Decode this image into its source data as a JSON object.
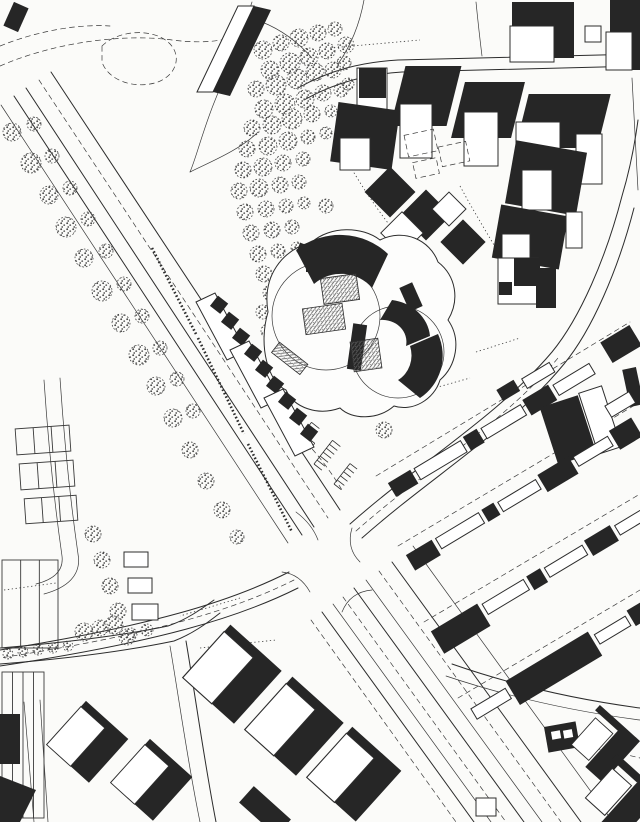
{
  "meta": {
    "kind": "scanned-site-plan-map",
    "width_px": 640,
    "height_px": 822,
    "visible_text": "none"
  },
  "palette": {
    "paper": "#fbfbf9",
    "ink": "#2c2c2c",
    "building_dark": "#262626",
    "tree_outline": "#414141",
    "hatch_gray": "#5c5c5c"
  },
  "features": {
    "park_woodland": "dense stippled tree cluster, upper centre-left",
    "main_avenue": "tree-lined avenue from top-left through central crossroads",
    "boulevard": "multi-lane boulevard from crossroads to bottom-right",
    "central_complex": "cloverleaf building complex with dark curved roofs and hatched courtyards",
    "ne_housing_cluster": "detached houses with dark roofs, top-right",
    "slab_housing": "diagonal rows of slab apartment blocks, right",
    "sports_courts": "court grid and field strips, left edge",
    "sw_villas": "houses with large cast shadows, bottom-left and bottom-centre",
    "terrace_row": "three stepped terrace slabs south-west of the complex",
    "pond": "dashed pond outline, top-left"
  },
  "map": {
    "trees": [
      [
        263,
        50,
        9
      ],
      [
        281,
        43,
        8
      ],
      [
        299,
        38,
        9
      ],
      [
        318,
        33,
        8
      ],
      [
        335,
        29,
        7
      ],
      [
        346,
        45,
        8
      ],
      [
        270,
        70,
        9
      ],
      [
        290,
        63,
        10
      ],
      [
        309,
        57,
        9
      ],
      [
        327,
        51,
        8
      ],
      [
        344,
        63,
        7
      ],
      [
        256,
        89,
        8
      ],
      [
        276,
        85,
        10
      ],
      [
        297,
        79,
        10
      ],
      [
        315,
        72,
        9
      ],
      [
        333,
        70,
        8
      ],
      [
        348,
        84,
        6
      ],
      [
        264,
        109,
        9
      ],
      [
        285,
        104,
        10
      ],
      [
        305,
        99,
        9
      ],
      [
        323,
        93,
        8
      ],
      [
        341,
        90,
        7
      ],
      [
        252,
        128,
        8
      ],
      [
        272,
        125,
        9
      ],
      [
        292,
        119,
        10
      ],
      [
        312,
        114,
        8
      ],
      [
        331,
        111,
        6
      ],
      [
        247,
        149,
        8
      ],
      [
        268,
        146,
        9
      ],
      [
        288,
        141,
        9
      ],
      [
        308,
        137,
        7
      ],
      [
        326,
        133,
        6
      ],
      [
        243,
        170,
        8
      ],
      [
        263,
        167,
        9
      ],
      [
        283,
        163,
        8
      ],
      [
        303,
        159,
        7
      ],
      [
        239,
        191,
        8
      ],
      [
        259,
        188,
        9
      ],
      [
        280,
        185,
        8
      ],
      [
        299,
        182,
        7
      ],
      [
        245,
        212,
        8
      ],
      [
        266,
        209,
        8
      ],
      [
        286,
        206,
        7
      ],
      [
        304,
        203,
        6
      ],
      [
        251,
        233,
        8
      ],
      [
        272,
        230,
        8
      ],
      [
        292,
        227,
        7
      ],
      [
        258,
        254,
        8
      ],
      [
        278,
        251,
        7
      ],
      [
        297,
        248,
        6
      ],
      [
        264,
        274,
        8
      ],
      [
        284,
        271,
        7
      ],
      [
        271,
        293,
        8
      ],
      [
        290,
        290,
        7
      ],
      [
        263,
        312,
        7
      ],
      [
        268,
        331,
        7
      ],
      [
        273,
        350,
        7
      ],
      [
        279,
        368,
        6
      ],
      [
        354,
        150,
        6
      ],
      [
        326,
        206,
        7
      ],
      [
        384,
        430,
        8
      ],
      [
        12,
        132,
        9
      ],
      [
        31,
        163,
        10
      ],
      [
        49,
        195,
        9
      ],
      [
        66,
        227,
        10
      ],
      [
        84,
        258,
        9
      ],
      [
        102,
        291,
        10
      ],
      [
        121,
        323,
        9
      ],
      [
        139,
        355,
        10
      ],
      [
        156,
        386,
        9
      ],
      [
        173,
        418,
        9
      ],
      [
        190,
        450,
        8
      ],
      [
        206,
        481,
        8
      ],
      [
        222,
        510,
        8
      ],
      [
        237,
        537,
        7
      ],
      [
        34,
        124,
        7
      ],
      [
        52,
        156,
        7
      ],
      [
        70,
        188,
        7
      ],
      [
        88,
        219,
        7
      ],
      [
        106,
        251,
        7
      ],
      [
        124,
        284,
        7
      ],
      [
        142,
        316,
        7
      ],
      [
        160,
        348,
        7
      ],
      [
        177,
        379,
        7
      ],
      [
        193,
        411,
        7
      ],
      [
        93,
        534,
        8
      ],
      [
        102,
        560,
        8
      ],
      [
        110,
        586,
        8
      ],
      [
        118,
        611,
        8
      ],
      [
        127,
        637,
        8
      ],
      [
        8,
        654,
        5
      ],
      [
        23,
        652,
        5
      ],
      [
        38,
        650,
        5
      ],
      [
        53,
        648,
        5
      ],
      [
        68,
        646,
        5
      ],
      [
        84,
        632,
        9
      ],
      [
        100,
        628,
        8
      ],
      [
        114,
        625,
        9
      ],
      [
        131,
        634,
        6
      ],
      [
        147,
        630,
        6
      ]
    ],
    "courts": [
      {
        "x": 16,
        "y": 427,
        "w": 54,
        "h": 26,
        "rot": -4
      },
      {
        "x": 20,
        "y": 462,
        "w": 54,
        "h": 26,
        "rot": -4
      },
      {
        "x": 25,
        "y": 497,
        "w": 52,
        "h": 25,
        "rot": -4
      }
    ],
    "fields": [
      {
        "x": 2,
        "y": 560,
        "w": 56,
        "h": 88,
        "lines": 2
      },
      {
        "x": 2,
        "y": 672,
        "w": 42,
        "h": 146,
        "lines": 3
      }
    ],
    "garages": [
      {
        "x": 124,
        "y": 552,
        "w": 24,
        "h": 15
      },
      {
        "x": 128,
        "y": 578,
        "w": 24,
        "h": 15
      },
      {
        "x": 132,
        "y": 604,
        "w": 26,
        "h": 16
      },
      {
        "x": 476,
        "y": 798,
        "w": 20,
        "h": 18
      }
    ],
    "parking_combs": [
      {
        "x": 293,
        "y": 446,
        "rot": -52,
        "n": 6,
        "len": 30,
        "tick": 10
      },
      {
        "x": 314,
        "y": 464,
        "rot": -52,
        "n": 6,
        "len": 30,
        "tick": 10
      },
      {
        "x": 334,
        "y": 484,
        "rot": -52,
        "n": 5,
        "len": 26,
        "tick": 9
      },
      {
        "x": 299,
        "y": 431,
        "rot": 38,
        "n": 4,
        "len": 20,
        "tick": 8
      }
    ]
  }
}
